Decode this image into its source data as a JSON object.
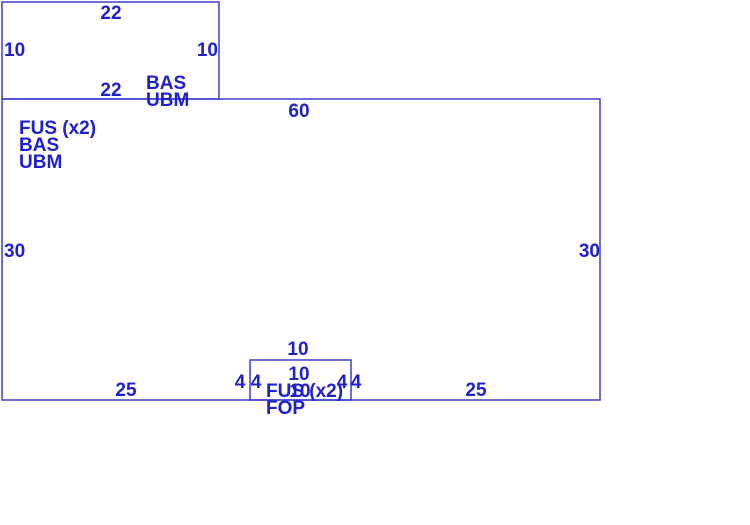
{
  "diagram": {
    "canvas": {
      "width": 750,
      "height": 525,
      "background": "#ffffff"
    },
    "colors": {
      "line": "#3c3ccd",
      "text": "#2020cc"
    },
    "shapes": [
      {
        "name": "upper-rect-outline",
        "x": 2,
        "y": 2,
        "width": 217,
        "height": 97
      },
      {
        "name": "main-rect-outline",
        "x": 2,
        "y": 99,
        "width": 598,
        "height": 301
      },
      {
        "name": "notch-rect-outline",
        "x": 250,
        "y": 360,
        "width": 101,
        "height": 40
      }
    ],
    "labels": [
      {
        "name": "upper-rect-dim-top",
        "text": "22",
        "x": 111,
        "y": 19,
        "anchor": "middle"
      },
      {
        "name": "upper-rect-dim-left",
        "text": "10",
        "x": 4,
        "y": 56,
        "anchor": "start"
      },
      {
        "name": "upper-rect-dim-right",
        "text": "10",
        "x": 218,
        "y": 56,
        "anchor": "end"
      },
      {
        "name": "upper-rect-dim-bottom",
        "text": "22",
        "x": 111,
        "y": 96,
        "anchor": "middle"
      },
      {
        "name": "upper-rect-layer-1",
        "text": "BAS",
        "x": 146,
        "y": 89,
        "anchor": "start"
      },
      {
        "name": "upper-rect-layer-2",
        "text": "UBM",
        "x": 146,
        "y": 106,
        "anchor": "start"
      },
      {
        "name": "main-rect-dim-top",
        "text": "60",
        "x": 299,
        "y": 117,
        "anchor": "middle"
      },
      {
        "name": "main-rect-layer-1",
        "text": "FUS (x2)",
        "x": 19,
        "y": 134,
        "anchor": "start"
      },
      {
        "name": "main-rect-layer-2",
        "text": "BAS",
        "x": 19,
        "y": 151,
        "anchor": "start"
      },
      {
        "name": "main-rect-layer-3",
        "text": "UBM",
        "x": 19,
        "y": 168,
        "anchor": "start"
      },
      {
        "name": "main-rect-dim-left",
        "text": "30",
        "x": 4,
        "y": 257,
        "anchor": "start"
      },
      {
        "name": "main-rect-dim-right",
        "text": "30",
        "x": 600,
        "y": 257,
        "anchor": "end"
      },
      {
        "name": "main-rect-dim-bottom-left",
        "text": "25",
        "x": 126,
        "y": 396,
        "anchor": "middle"
      },
      {
        "name": "main-rect-dim-bottom-right",
        "text": "25",
        "x": 476,
        "y": 396,
        "anchor": "middle"
      },
      {
        "name": "notch-rect-dim-top-outside",
        "text": "10",
        "x": 298,
        "y": 355,
        "anchor": "middle"
      },
      {
        "name": "notch-rect-dim-top",
        "text": "10",
        "x": 299,
        "y": 380,
        "anchor": "middle"
      },
      {
        "name": "notch-rect-dim-bottom",
        "text": "10",
        "x": 300,
        "y": 397,
        "anchor": "middle"
      },
      {
        "name": "notch-rect-dim-left-outside",
        "text": "4",
        "x": 240,
        "y": 388,
        "anchor": "middle"
      },
      {
        "name": "notch-rect-dim-left",
        "text": "4",
        "x": 256,
        "y": 388,
        "anchor": "middle"
      },
      {
        "name": "notch-rect-dim-right",
        "text": "4",
        "x": 342,
        "y": 388,
        "anchor": "middle"
      },
      {
        "name": "notch-rect-dim-right-outside",
        "text": "4",
        "x": 356,
        "y": 388,
        "anchor": "middle"
      },
      {
        "name": "notch-rect-layer-1",
        "text": "FUS (x2)",
        "x": 266,
        "y": 397,
        "anchor": "start"
      },
      {
        "name": "notch-rect-layer-2",
        "text": "FOP",
        "x": 266,
        "y": 414,
        "anchor": "start"
      }
    ]
  }
}
